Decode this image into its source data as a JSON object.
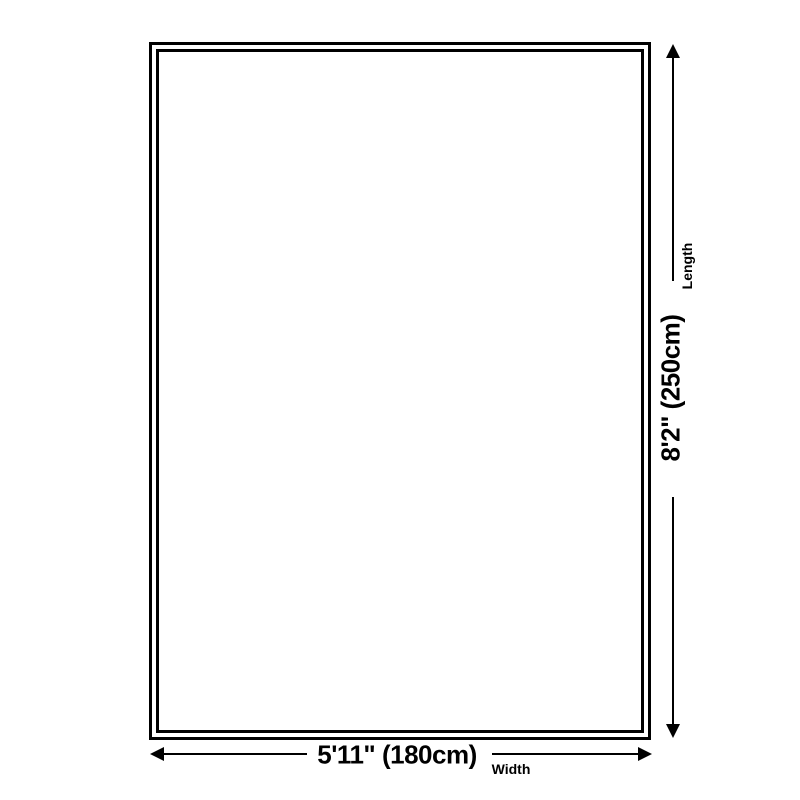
{
  "diagram": {
    "type": "product-size-diagram",
    "shape": "rectangle",
    "length": {
      "value": "8'2\" (250cm)",
      "label": "Length"
    },
    "width": {
      "value": "5'11\" (180cm)",
      "label": "Width"
    },
    "colors": {
      "line": "#000000",
      "background": "#ffffff"
    }
  }
}
